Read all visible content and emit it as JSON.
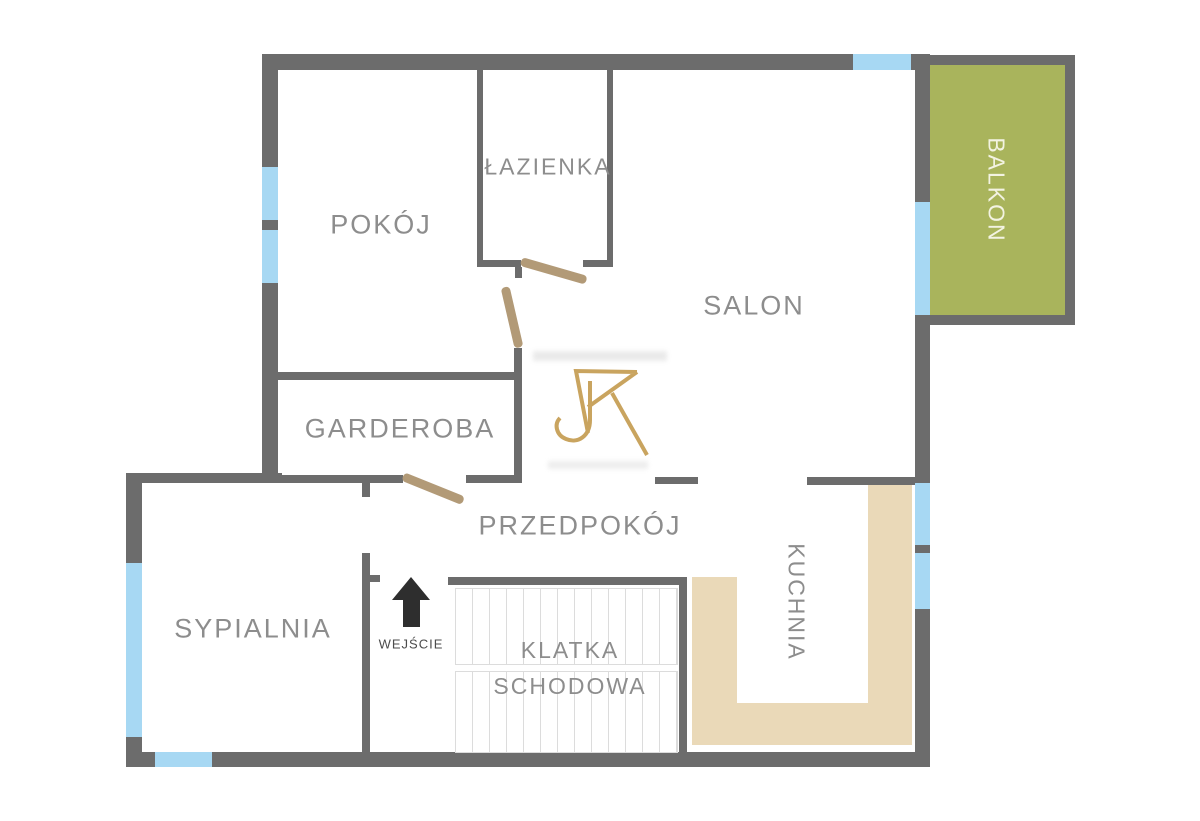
{
  "plan": {
    "title": "floor-plan",
    "rooms": {
      "pokoj": {
        "label": "POKÓJ"
      },
      "lazienka": {
        "label": "ŁAZIENKA"
      },
      "salon": {
        "label": "SALON"
      },
      "garderoba": {
        "label": "GARDEROBA"
      },
      "przedpokoj": {
        "label": "PRZEDPOKÓJ"
      },
      "sypialnia": {
        "label": "SYPIALNIA"
      },
      "kuchnia": {
        "label": "KUCHNIA"
      },
      "klatka": {
        "label_line1": "KLATKA",
        "label_line2": "SCHODOWA"
      },
      "balkon": {
        "label": "BALKON"
      }
    },
    "entrance": {
      "label": "WEJŚCIE"
    },
    "logo": {
      "name": "jk-monogram"
    }
  },
  "colors": {
    "wall": "#6c6c6c",
    "window": "#a7d8f3",
    "balcony": "#a9b45c",
    "balcony_text": "#f3f3e2",
    "counter": "#ead9b8",
    "door": "#b29a77",
    "label": "#8d8d8d",
    "entrance_text": "#4b4b4b",
    "arrow": "#2e2e2e",
    "gold": "#c9a45f",
    "stair_line": "#dcdcdc"
  }
}
